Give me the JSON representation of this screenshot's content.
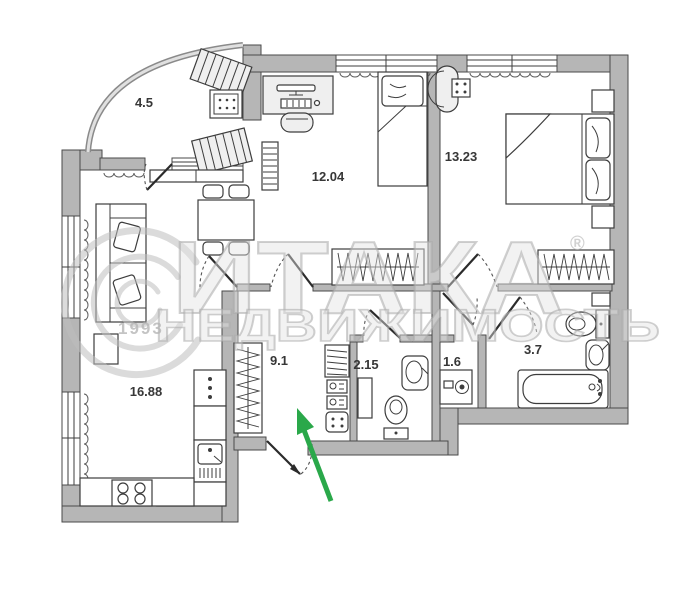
{
  "plan": {
    "title": "apartment-floor-plan",
    "rooms": {
      "balcony": {
        "area": "4.5"
      },
      "bedroom_child": {
        "area": "12.04"
      },
      "bedroom_master": {
        "area": "13.23"
      },
      "kitchen_living": {
        "area": "16.88"
      },
      "hallway": {
        "area": "9.1"
      },
      "bathroom_small": {
        "area": "2.15"
      },
      "storage": {
        "area": "1.6"
      },
      "bathroom_large": {
        "area": "3.7"
      }
    }
  },
  "watermark": {
    "brand": "ИТАКА",
    "registered": "®",
    "subtitle": "НЕДВИЖИМОСТЬ",
    "year": "1993"
  },
  "colors": {
    "wall": "#b6b6b6",
    "wall_stroke": "#4a4a4a",
    "line": "#3d3d3d",
    "entrance_arrow": "#2aa84a",
    "watermark": "#bdbdbd",
    "label_text": "#373737",
    "background": "#ffffff"
  },
  "icons": [
    "sofa-icon",
    "dining-table-icon",
    "lounger-icon",
    "desk-computer-icon",
    "office-chair-icon",
    "single-bed-icon",
    "double-bed-icon",
    "nightstand-icon",
    "wardrobe-icon",
    "fridge-icon",
    "kitchen-sink-icon",
    "stove-icon",
    "toilet-icon",
    "washbasin-icon",
    "bathtub-icon",
    "washing-machine-icon",
    "radiator-icon",
    "entrance-arrow-icon",
    "door-swing-icon",
    "window-icon"
  ]
}
